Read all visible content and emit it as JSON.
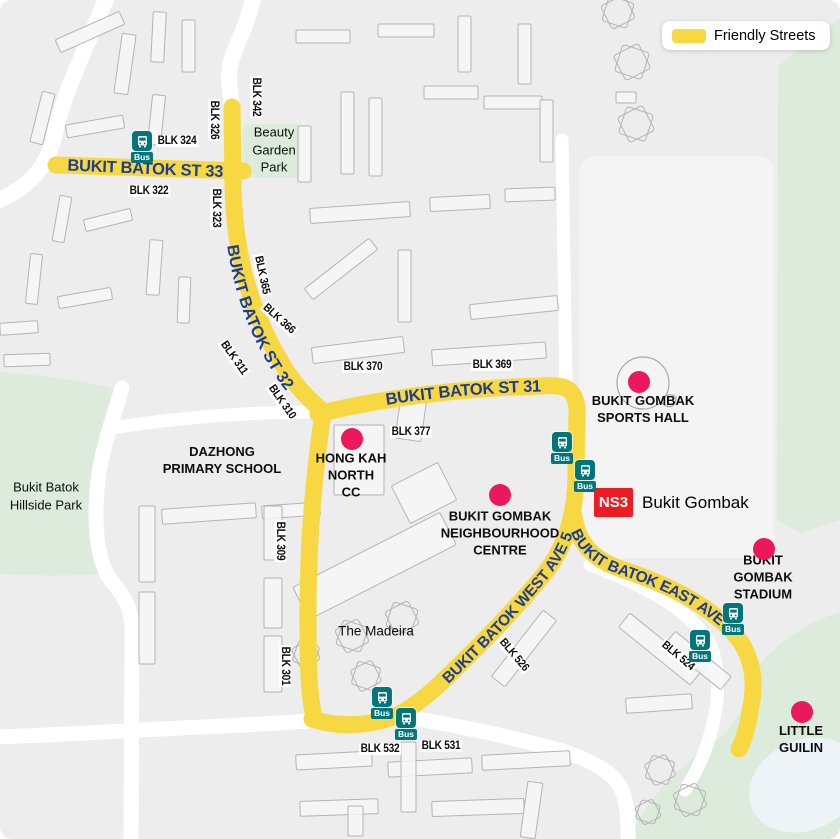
{
  "legend": {
    "label": "Friendly Streets",
    "color": "#f7d843"
  },
  "colors": {
    "friendly_yellow": "#f7d843",
    "road_label_blue": "#1d3d91",
    "poi_pink": "#ec185c",
    "mrt_red": "#ed1c24",
    "bus_teal": "#00767c",
    "park_green": "#dcebdc",
    "lake_blue": "#eef3f8",
    "map_background": "#ededed"
  },
  "roads": [
    {
      "id": "st33",
      "name": "BUKIT BATOK ST 33"
    },
    {
      "id": "st32",
      "name": "BUKIT BATOK ST 32"
    },
    {
      "id": "st31",
      "name": "BUKIT BATOK ST 31"
    },
    {
      "id": "west5",
      "name": "BUKIT BATOK WEST AVE 5"
    },
    {
      "id": "east5",
      "name": "BUKIT BATOK EAST AVE 5"
    }
  ],
  "blocks": [
    {
      "id": "blk324",
      "text": "BLK 324"
    },
    {
      "id": "blk342",
      "text": "BLK 342"
    },
    {
      "id": "blk326",
      "text": "BLK 326"
    },
    {
      "id": "blk322",
      "text": "BLK 322"
    },
    {
      "id": "blk323",
      "text": "BLK 323"
    },
    {
      "id": "blk365",
      "text": "BLK 365"
    },
    {
      "id": "blk366",
      "text": "BLK 366"
    },
    {
      "id": "blk311",
      "text": "BLK 311"
    },
    {
      "id": "blk310",
      "text": "BLK 310"
    },
    {
      "id": "blk370",
      "text": "BLK 370"
    },
    {
      "id": "blk369",
      "text": "BLK 369"
    },
    {
      "id": "blk377",
      "text": "BLK 377"
    },
    {
      "id": "blk309",
      "text": "BLK 309"
    },
    {
      "id": "blk301",
      "text": "BLK 301"
    },
    {
      "id": "blk526",
      "text": "BLK 526"
    },
    {
      "id": "blk524",
      "text": "BLK 524"
    },
    {
      "id": "blk532",
      "text": "BLK 532"
    },
    {
      "id": "blk531",
      "text": "BLK 531"
    }
  ],
  "places": [
    {
      "id": "beauty-garden-park",
      "text": "Beauty\nGarden\nPark"
    },
    {
      "id": "hillside-park",
      "text": "Bukit Batok\nHillside Park"
    },
    {
      "id": "dazhong-primary",
      "text": "DAZHONG\nPRIMARY SCHOOL"
    },
    {
      "id": "hong-kah-north-cc",
      "text": "HONG KAH\nNORTH\nCC"
    },
    {
      "id": "sports-hall",
      "text": "BUKIT GOMBAK\nSPORTS HALL"
    },
    {
      "id": "neighbourhood-centre",
      "text": "BUKIT GOMBAK\nNEIGHBOURHOOD\nCENTRE"
    },
    {
      "id": "stadium",
      "text": "BUKIT GOMBAK\nSTADIUM"
    },
    {
      "id": "little-guilin",
      "text": "LITTLE\nGUILIN"
    },
    {
      "id": "the-madeira",
      "text": "The Madeira"
    }
  ],
  "mrt": {
    "code": "NS3",
    "name": "Bukit Gombak"
  },
  "bus": {
    "label": "Bus"
  }
}
